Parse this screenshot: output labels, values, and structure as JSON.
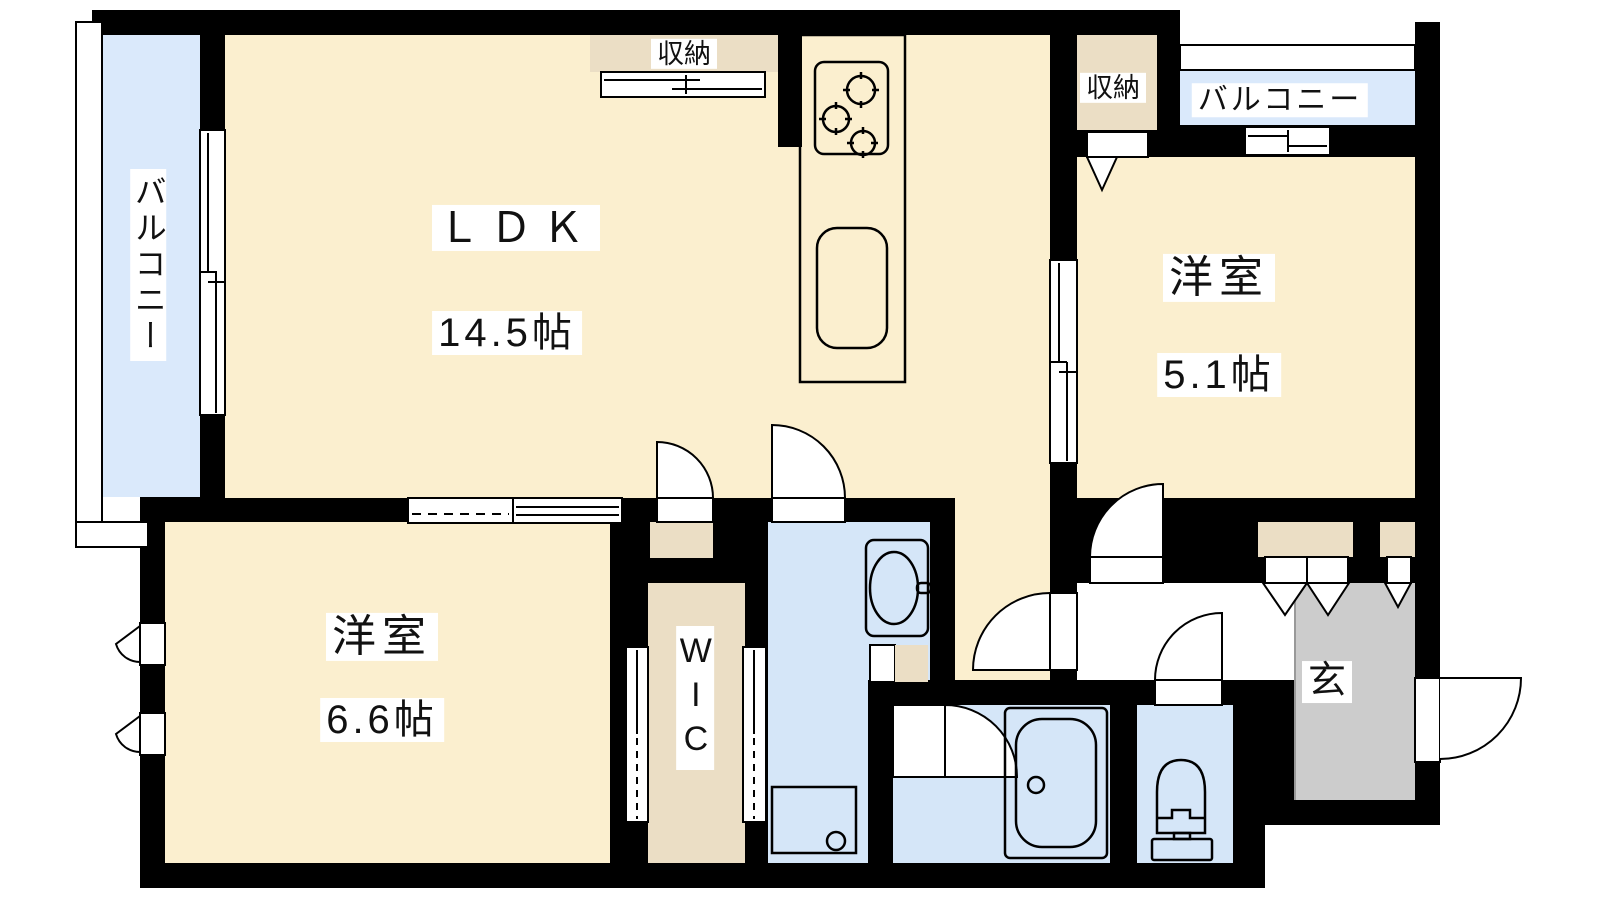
{
  "floorplan": {
    "labels": {
      "ldk": "ＬＤＫ",
      "ldk_size": "14.5帖",
      "bedroom1": "洋室",
      "bedroom1_size": "5.1帖",
      "bedroom2": "洋室",
      "bedroom2_size": "6.6帖",
      "wic": "WIC",
      "genkan": "玄",
      "balcony_left": "バルコニー",
      "balcony_right": "バルコニー",
      "storage_top": "収納",
      "storage_right": "収納"
    },
    "colors": {
      "wall": "#000000",
      "room_cream": "#FBEFCF",
      "storage_beige": "#EBDEC5",
      "water_blue": "#D5E6F8",
      "balcony_blue": "#DAE9FB",
      "genkan_gray": "#CCCCCC",
      "line": "#000000",
      "label_bg": "#FFFFFF"
    }
  }
}
